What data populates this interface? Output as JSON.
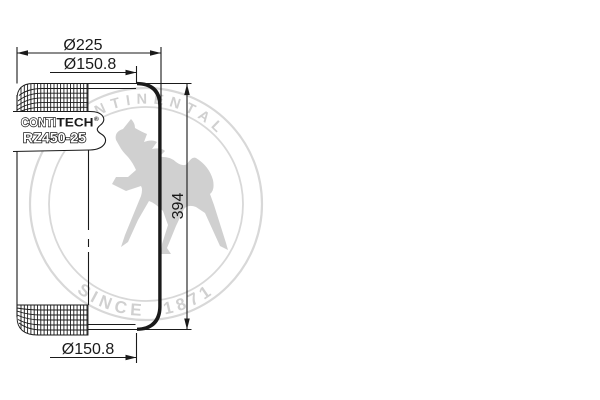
{
  "meta": {
    "background_color": "#ffffff",
    "line_color": "#1a1a1a",
    "watermark_color": "#d0d0d0"
  },
  "watermark": {
    "brand_arc_text": "CONTINENTAL",
    "bottom_arc_text": "SINCE 1871",
    "horse_icon": "rearing-horse"
  },
  "label_plate": {
    "brand_outline": "CONTI",
    "brand_solid": "TECH",
    "registered_mark": "®",
    "part_number": "RZ450-25"
  },
  "dimensions": {
    "outer_diameter": "Ø225",
    "top_bead_diameter": "Ø150.8",
    "overall_height": "394",
    "bottom_bead_diameter": "Ø150.8"
  }
}
